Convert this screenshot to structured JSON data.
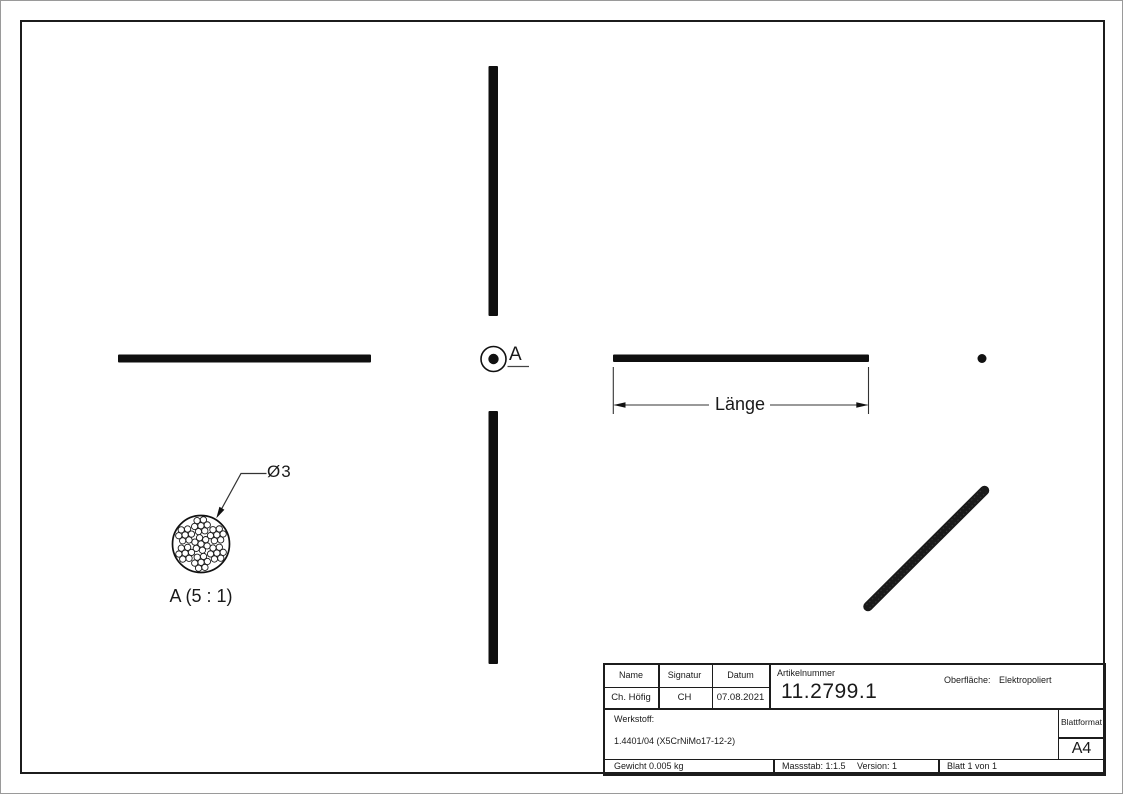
{
  "views": {
    "detail_callout_label": "A",
    "detail_view_title": "A (5 : 1)",
    "diameter_dimension": "Ø3",
    "length_dimension": "Länge"
  },
  "title_block": {
    "name_header": "Name",
    "signature_header": "Signatur",
    "date_header": "Datum",
    "name_value": "Ch. Höfig",
    "signature_value": "CH",
    "date_value": "07.08.2021",
    "article_label": "Artikelnummer",
    "article_number": "11.2799.1",
    "surface_label": "Oberfläche:",
    "surface_value": "Elektropoliert",
    "material_label": "Werkstoff:",
    "material_value": "1.4401/04 (X5CrNiMo17-12-2)",
    "sheet_format_label": "Blattformat",
    "sheet_format_value": "A4",
    "weight": "Gewicht 0.005 kg",
    "scale": "Massstab: 1:1.5",
    "version": "Version: 1",
    "sheet_number": "Blatt 1 von 1"
  },
  "colors": {
    "line": "#1a1a1a",
    "background": "#ffffff"
  }
}
